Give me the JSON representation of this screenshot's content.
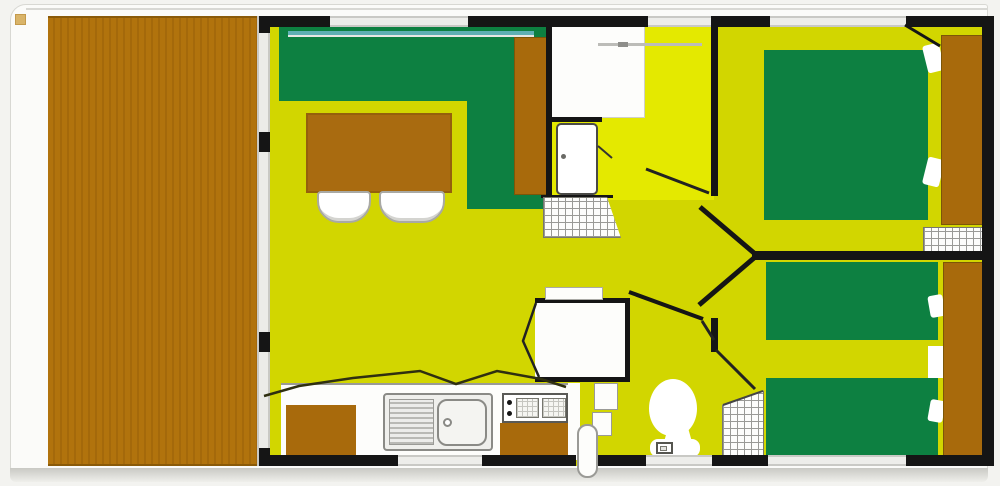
{
  "plan_title": "Mobile home floor plan",
  "palette": {
    "deck_wood": "#b1730d",
    "deck_wood_groove": "#a4690b",
    "furniture_wood": "#a86a0c",
    "upholstery_green": "#0d8041",
    "floor_yellow": "#d2d600",
    "hall_floor_yellow": "#e4e900",
    "wall_black": "#151515",
    "fixture_white": "#fdfdfb",
    "window_gray": "#ededea",
    "glazing_teal": "#5fb0b4"
  },
  "areas": {
    "terrace": {
      "label": "Terrace deck"
    },
    "living": {
      "label": "Living room"
    },
    "hall": {
      "label": "Entrance hall"
    },
    "kitchen": {
      "label": "Kitchen"
    },
    "shower_room": {
      "label": "Shower room"
    },
    "wc": {
      "label": "WC"
    },
    "bedroom_double": {
      "label": "Double bedroom"
    },
    "bedroom_twin": {
      "label": "Twin bedroom"
    }
  },
  "furniture": {
    "corner_sofa": "Corner sofa",
    "dining_table": "Dining table",
    "chair_left": "Chair",
    "chair_right": "Chair",
    "sideboard": "Sideboard",
    "hall_closet": "Closet",
    "entrance_door": "Entrance door",
    "doormat": "Doormat",
    "sink": "Sink with drainer",
    "hob": "Two-burner hob",
    "kitchen_cabinet_left": "Kitchen cabinet",
    "kitchen_cabinet_right": "Kitchen cabinet",
    "water_heater": "Water heater",
    "shower": "Shower cubicle",
    "washbasin": "Washbasin",
    "toilet": "Toilet",
    "double_bed": "Double bed",
    "single_bed_top": "Single bed",
    "single_bed_bottom": "Single bed",
    "wardrobe_double_room": "Wardrobe",
    "wardrobe_twin_room": "Wardrobe",
    "shelf_double_room": "Shelf unit",
    "shelf_wc": "Shelf unit"
  }
}
